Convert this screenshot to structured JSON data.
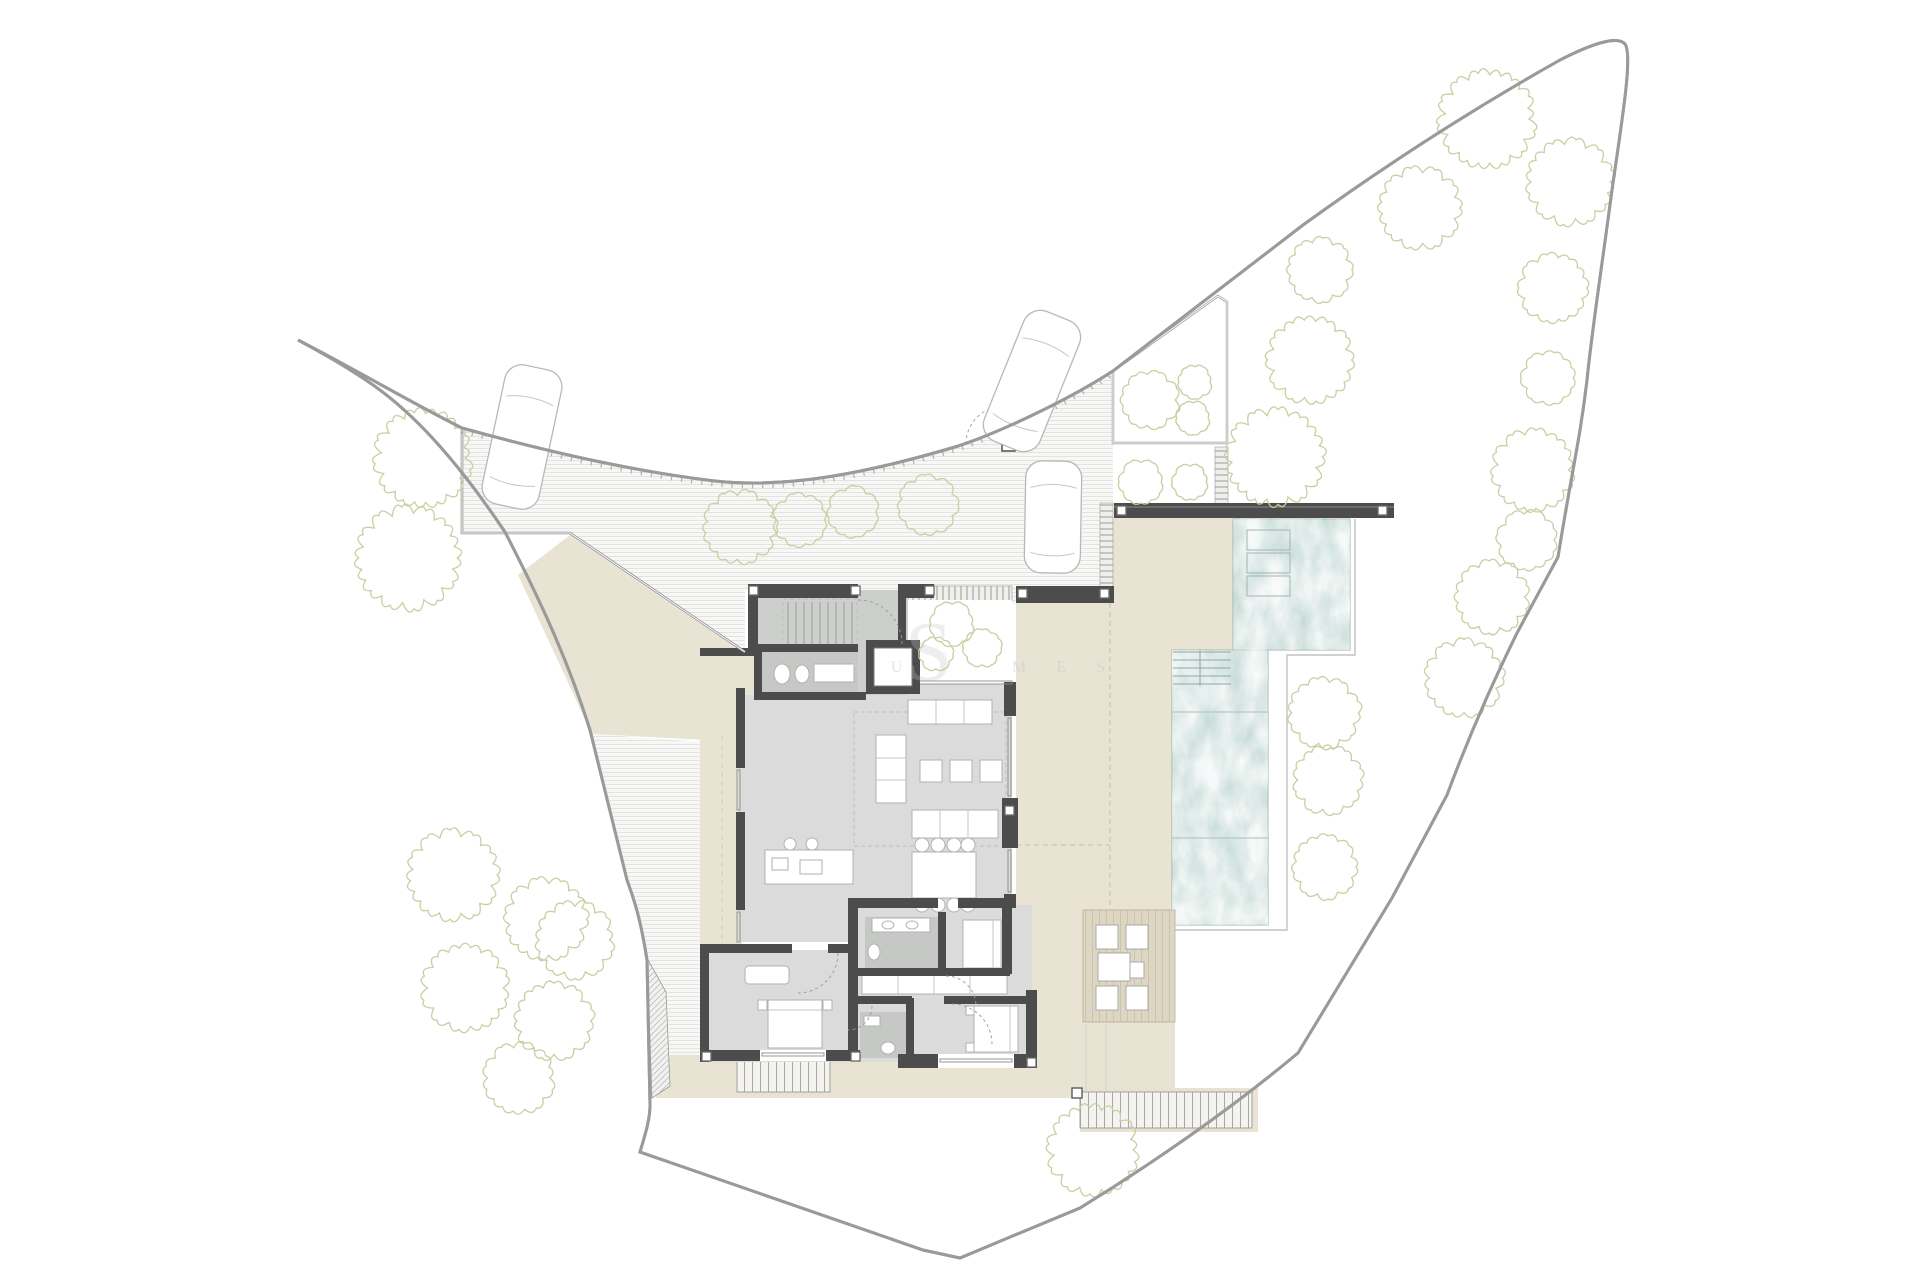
{
  "page": {
    "background": "#ffffff",
    "watermark": {
      "logo_letter": "S",
      "text_left": "S U",
      "text_right": "M E S"
    }
  },
  "colors": {
    "wall": "#4b4c4b",
    "floor": "#dadbda",
    "floor_dark": "#cdcfcd",
    "bath_floor": "#c6c8c6",
    "terrace": "#e8e3d3",
    "water": "#c6dbd7",
    "water_line": "#9fb6b2",
    "deck": "#ddd6c3",
    "tree": "#c9cfa2",
    "boundary": "#9a9a9a",
    "furniture": "#b5b5b5",
    "hatch": "#e3e3e2"
  },
  "site": {
    "trees": [
      {
        "x": 740,
        "y": 527,
        "r": 34
      },
      {
        "x": 800,
        "y": 520,
        "r": 25
      },
      {
        "x": 853,
        "y": 512,
        "r": 24
      },
      {
        "x": 928,
        "y": 505,
        "r": 28
      },
      {
        "x": 423,
        "y": 458,
        "r": 45
      },
      {
        "x": 408,
        "y": 558,
        "r": 48
      },
      {
        "x": 575,
        "y": 940,
        "r": 36
      },
      {
        "x": 453,
        "y": 875,
        "r": 42
      },
      {
        "x": 546,
        "y": 919,
        "r": 38
      },
      {
        "x": 465,
        "y": 988,
        "r": 40
      },
      {
        "x": 554,
        "y": 1021,
        "r": 36
      },
      {
        "x": 519,
        "y": 1078,
        "r": 33
      },
      {
        "x": 1093,
        "y": 1150,
        "r": 42
      },
      {
        "x": 1324,
        "y": 713,
        "r": 33
      },
      {
        "x": 1328,
        "y": 780,
        "r": 32
      },
      {
        "x": 1325,
        "y": 867,
        "r": 30
      },
      {
        "x": 1275,
        "y": 457,
        "r": 45
      },
      {
        "x": 1141,
        "y": 482,
        "r": 21
      },
      {
        "x": 1190,
        "y": 482,
        "r": 17
      },
      {
        "x": 1150,
        "y": 400,
        "r": 27
      },
      {
        "x": 1195,
        "y": 382,
        "r": 16
      },
      {
        "x": 1193,
        "y": 418,
        "r": 16
      },
      {
        "x": 1320,
        "y": 270,
        "r": 30
      },
      {
        "x": 1310,
        "y": 360,
        "r": 40
      },
      {
        "x": 1420,
        "y": 208,
        "r": 38
      },
      {
        "x": 1487,
        "y": 119,
        "r": 45
      },
      {
        "x": 1570,
        "y": 182,
        "r": 40
      },
      {
        "x": 1553,
        "y": 288,
        "r": 32
      },
      {
        "x": 1548,
        "y": 378,
        "r": 25
      },
      {
        "x": 1533,
        "y": 470,
        "r": 38
      },
      {
        "x": 1527,
        "y": 540,
        "r": 28
      },
      {
        "x": 1492,
        "y": 597,
        "r": 34
      },
      {
        "x": 1464,
        "y": 678,
        "r": 36
      },
      {
        "x": 952,
        "y": 624,
        "r": 21
      },
      {
        "x": 982,
        "y": 648,
        "r": 18
      },
      {
        "x": 936,
        "y": 654,
        "r": 16
      }
    ],
    "cars": [
      {
        "cx": 522,
        "cy": 437,
        "w": 58,
        "h": 142,
        "angle": 12
      },
      {
        "cx": 1032,
        "cy": 381,
        "w": 60,
        "h": 140,
        "angle": 22
      },
      {
        "cx": 1053,
        "cy": 517,
        "w": 56,
        "h": 112,
        "angle": 1
      }
    ]
  }
}
